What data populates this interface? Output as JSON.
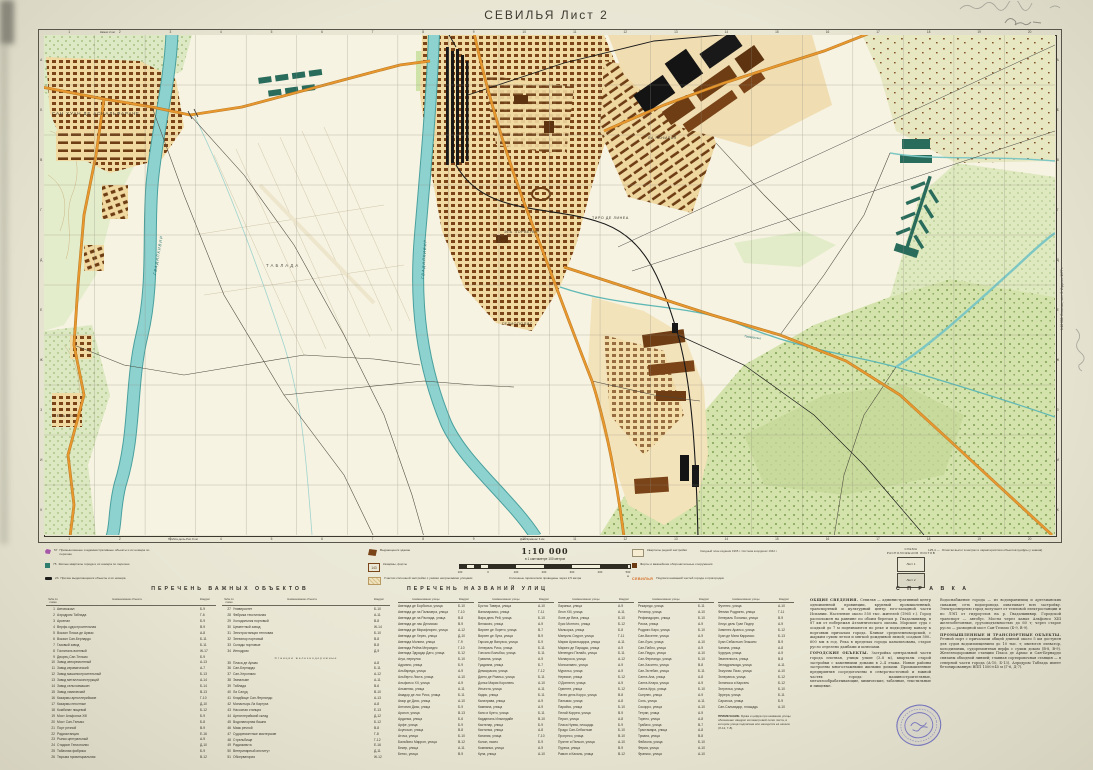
{
  "page": {
    "title": "СЕВИЛЬЯ  Лист 2",
    "edition_note": "1:10 000. Севилья, лист 2. Издание 1977 г.",
    "edge_notes": {
      "top": "Камас 2 км",
      "bottom1": "Пуэбла-дель-Рио 9 км",
      "bottom2": "Дос-Эрманас 6 км"
    }
  },
  "colors": {
    "paper": "#e9e6d4",
    "water": "#8ed2cf",
    "road": "#e8982e",
    "forest": "#d4e3ab",
    "building": "#7a4418",
    "stamp": "#5c5cb8"
  },
  "map": {
    "grid_cols": [
      "1",
      "2",
      "3",
      "4",
      "5",
      "6",
      "7",
      "8",
      "9",
      "10",
      "11",
      "12",
      "13",
      "14",
      "15",
      "16",
      "17",
      "18",
      "19",
      "20"
    ],
    "grid_rows": [
      "А",
      "Б",
      "В",
      "Г",
      "Д",
      "Е",
      "Ж",
      "З",
      "И",
      "К"
    ],
    "labels": {
      "town1": "САН ХУАН ДЕ АСНАЛЬФАРАЧЕ",
      "river1": "ГВАДАЛКИВИР",
      "river2": "ГВАДАЛКИВИР",
      "airfield": "ТАБЛАДА",
      "district1": "ТИРО ДЕ ЛИНЕА",
      "district2": "ЭЛЬ ПОРВЕНИР",
      "district3": "ГЕЛИОПОЛИС",
      "district4": "ЛА РАНИЛЬЯ",
      "village1": "ГЕЛЬВЕС",
      "stream1": "Тамаргильо"
    }
  },
  "scale": {
    "main": "1:10 000",
    "sub": "в 1 сантиметре 100 метров",
    "bar_labels": [
      "100",
      "0",
      "100",
      "200",
      "300",
      "400",
      "500 м"
    ],
    "contour_note": "Сплошные горизонтали проведены через 2,5 метра",
    "coord_note": "Сводный план издания 1965 г. Система координат 1942 г."
  },
  "scheme": {
    "title1": "СХЕМА",
    "title2": "РАСПОЛОЖЕНИЯ ЛИСТОВ",
    "sheets": [
      "Лист 1",
      "Лист 2"
    ]
  },
  "legend": {
    "items": [
      {
        "num": "57",
        "label": "Промышленные и административные объекты и их номера по перечню"
      },
      {
        "num": "75",
        "label": "Жилые кварталы города и их номера по перечню"
      },
      {
        "num": "23",
        "label": "Прочие выделяющиеся объекты и их номера"
      },
      {
        "num": "",
        "label": "Выдающееся здание"
      },
      {
        "num": "143",
        "label": "Казармы, форты"
      },
      {
        "num": "",
        "label": "Участки сплошной застройки с узкими непроезжими улицами"
      },
      {
        "num": "",
        "label": "Кварталы редкой застройки"
      },
      {
        "num": "",
        "label": "Форты и важнейшие оборонительные сооружения"
      },
      {
        "num": "СЕВИЛЬЯ",
        "label": "Подписи названий частей города и пригородов"
      },
      {
        "num": "125,4 —",
        "label": "Отметки высот в метрах и характеристики объектов (цифры у знаков)"
      }
    ]
  },
  "objects_table": {
    "title": "ПЕРЕЧЕНЬ  ВАЖНЫХ  ОБЪЕКТОВ",
    "headers": [
      "№№ по схеме",
      "Наименование объекта",
      "Квадрат"
    ],
    "groups": [
      [
        [
          "1",
          "Автовокзал",
          "Б-9"
        ],
        [
          "2",
          "Аэродром Таблада",
          "Г-6"
        ],
        [
          "3",
          "Арсенал",
          "Б-9"
        ],
        [
          "4",
          "Верфь судостроительная",
          "В-9"
        ],
        [
          "5",
          "Вокзал Пласа де Армас",
          "А-8"
        ],
        [
          "6",
          "Вокзал Сан-Бернардо",
          "Б-11"
        ],
        [
          "7",
          "Газовый завод",
          "Б-11"
        ],
        [
          "8",
          "Госпиталь военный",
          "Ж-17"
        ],
        [
          "9",
          "Дворец Сан-Тельмо",
          "Б-9"
        ],
        [
          "10",
          "Завод авторемонтный",
          "А-13"
        ],
        [
          "11",
          "Завод керамический",
          "А-7"
        ],
        [
          "12",
          "Завод машиностроительный",
          "Б-13"
        ],
        [
          "13",
          "Завод металлоконструкций",
          "А-14"
        ],
        [
          "14",
          "Завод сельхозмашин",
          "Б-14"
        ],
        [
          "15",
          "Завод химический",
          "В-13"
        ],
        [
          "16",
          "Казармы артиллерийские",
          "Г-10"
        ],
        [
          "17",
          "Казармы пехотные",
          "Д-10"
        ],
        [
          "18",
          "Комбинат пищевой",
          "Б-12"
        ],
        [
          "19",
          "Мост Альфонса XIII",
          "Б-9"
        ],
        [
          "20",
          "Мост Сан-Тельмо",
          "Б-8"
        ],
        [
          "21",
          "Порт речной",
          "В-9"
        ],
        [
          "22",
          "Радиостанция",
          "Е-16"
        ],
        [
          "23",
          "Рынок центральный",
          "А-9"
        ],
        [
          "24",
          "Стадион Гелиополис",
          "Д-10"
        ],
        [
          "25",
          "Табачная фабрика",
          "Б-9"
        ],
        [
          "26",
          "Тюрьма провинциальная",
          "В-12"
        ]
      ],
      [
        [
          "27",
          "Университет",
          "Б-10"
        ],
        [
          "28",
          "Фабрика текстильная",
          "А-11"
        ],
        [
          "29",
          "Холодильник портовый",
          "В-8"
        ],
        [
          "30",
          "Цементный завод",
          "Ж-14"
        ],
        [
          "31",
          "Электростанция тепловая",
          "Б-10"
        ],
        [
          "32",
          "Элеватор портовый",
          "В-8"
        ],
        [
          "33",
          "Склады портовые",
          "В-8"
        ],
        [
          "34",
          "Ипподром",
          "Д-9"
        ],
        {
          "sub": "Станции железнодорожные"
        },
        [
          "35",
          "Пласа де Армас",
          "А-8"
        ],
        [
          "36",
          "Сан-Бернардо",
          "Б-11"
        ],
        [
          "37",
          "Сан-Херонимо",
          "А-12"
        ],
        [
          "38",
          "Эмпальме",
          "А-11"
        ],
        [
          "39",
          "Таблада",
          "В-6"
        ],
        [
          "40",
          "Ла Салуд",
          "В-10"
        ],
        [
          "41",
          "Кладбище Сан-Фернандо",
          "А-13"
        ],
        [
          "42",
          "Монастырь Ла Картуха",
          "А-8"
        ],
        [
          "43",
          "Насосная станция",
          "Е-13"
        ],
        [
          "44",
          "Артиллерийский склад",
          "Д-12"
        ],
        [
          "45",
          "Водонапорная башня",
          "Б-12"
        ],
        [
          "46",
          "Маяк речной",
          "В-8"
        ],
        [
          "47",
          "Судоремонтные мастерские",
          "Г-8"
        ],
        [
          "48",
          "Стрельбище",
          "Г-12"
        ],
        [
          "49",
          "Радиомачта",
          "Е-16"
        ],
        [
          "50",
          "Ветеринарный институт",
          "Д-11"
        ],
        [
          "51",
          "Обсерватория",
          "Ж-12"
        ]
      ]
    ]
  },
  "streets_table": {
    "title": "ПЕРЕЧЕНЬ  НАЗВАНИЙ  УЛИЦ",
    "headers": [
      "Наименование улицы",
      "Квадрат"
    ],
    "groups": [
      [
        [
          "Авенида де Борболья, улица",
          "Б-10"
        ],
        [
          "Авенида де ла Пальмера, улица",
          "Г-10"
        ],
        [
          "Авенида де ла Распида, улица",
          "В-8"
        ],
        [
          "Авенида де лас Делисиас",
          "В-9"
        ],
        [
          "Авенида де Мирафлорес, улица",
          "А-12"
        ],
        [
          "Авенида де Херес, улица",
          "Д-10"
        ],
        [
          "Авенида Молини, улица",
          "Г-9"
        ],
        [
          "Авенида Рейна Мерседес",
          "Г-10"
        ],
        [
          "Авенида Эдуардо Дато, улица",
          "Б-12"
        ],
        [
          "Агуа, переулок",
          "Б-10"
        ],
        [
          "Адриано, улица",
          "Б-9"
        ],
        [
          "Альбареда, улица",
          "А-9"
        ],
        [
          "Альберто Листа, улица",
          "А-10"
        ],
        [
          "Альфонсо XII, улица",
          "А-9"
        ],
        [
          "Альменас, улица",
          "А-11"
        ],
        [
          "Амадор де лос Риос, улица",
          "Б-11"
        ],
        [
          "Амор де Диос, улица",
          "А-10"
        ],
        [
          "Антония Диас, улица",
          "Б-9"
        ],
        [
          "Арагон, улица",
          "В-13"
        ],
        [
          "Ардилья, улица",
          "Б-6"
        ],
        [
          "Арфе, улица",
          "Б-9"
        ],
        [
          "Асунсьон, улица",
          "В-8"
        ],
        [
          "Аточа, улица",
          "Б-10"
        ],
        [
          "Бальбино Маррон, улица",
          "В-12"
        ],
        [
          "Бекер, улица",
          "А-11"
        ],
        [
          "Бетис, улица",
          "В-9"
        ]
      ],
      [
        [
          "Бустос Тавера, улица",
          "А-10"
        ],
        [
          "Вальпараисо, улица",
          "Г-11"
        ],
        [
          "Вара дель Рей, улица",
          "Б-10"
        ],
        [
          "Веласкес, улица",
          "А-9"
        ],
        [
          "Вирхен де Лорето, улица",
          "В-7"
        ],
        [
          "Вирхен де Луха, улица",
          "В-9"
        ],
        [
          "Гарсия де Винуэса, улица",
          "Б-9"
        ],
        [
          "Хенераль Риос, улица",
          "Б-11"
        ],
        [
          "Гонсало Бильбао, улица",
          "Б-11"
        ],
        [
          "Гравина, улица",
          "А-9"
        ],
        [
          "Гуадиана, улица",
          "Б-7"
        ],
        [
          "Демокрасия, улица",
          "Г-12"
        ],
        [
          "Диего де Рианьо, улица",
          "Б-11"
        ],
        [
          "Донья Мария Коронель",
          "А-10"
        ],
        [
          "Иньеста, улица",
          "А-11"
        ],
        [
          "Кадис, улица",
          "Б-11"
        ],
        [
          "Калатрава, улица",
          "А-9"
        ],
        [
          "Кампана, улица",
          "А-9"
        ],
        [
          "Кано и Куэто, улица",
          "Б-11"
        ],
        [
          "Кардиналь Ильюндайн",
          "В-10"
        ],
        [
          "Кастелар, улица",
          "Б-9"
        ],
        [
          "Кастилья, улица",
          "А-8"
        ],
        [
          "Катания, улица",
          "Г-10"
        ],
        [
          "Колон, пасео",
          "Б-9"
        ],
        [
          "Компанья, улица",
          "А-9"
        ],
        [
          "Куна, улица",
          "А-10"
        ]
      ],
      [
        [
          "Лараньи, улица",
          "А-9"
        ],
        [
          "Леон XIII, улица",
          "А-11"
        ],
        [
          "Лопе де Вега, улица",
          "Б-10"
        ],
        [
          "Луис Монтото, улица",
          "Б-12"
        ],
        [
          "Мальорка, улица",
          "Б-8"
        ],
        [
          "Мануэль Сиурот, улица",
          "Г-11"
        ],
        [
          "Мария Аусильядора, улица",
          "А-11"
        ],
        [
          "Маркес де Парадас, улица",
          "А-9"
        ],
        [
          "Менендес Пелайо, улица",
          "Б-11"
        ],
        [
          "Милагроса, улица",
          "А-12"
        ],
        [
          "Монсальвес, улица",
          "А-9"
        ],
        [
          "Мурильо, улица",
          "А-9"
        ],
        [
          "Нервион, улица",
          "Б-12"
        ],
        [
          "О'Доннелл, улица",
          "А-9"
        ],
        [
          "Ориенте, улица",
          "Б-12"
        ],
        [
          "Пахес дель Корро, улица",
          "В-8"
        ],
        [
          "Пальмас, улица",
          "А-8"
        ],
        [
          "Парайсо, улица",
          "Б-10"
        ],
        [
          "Пелай Корреа, улица",
          "В-9"
        ],
        [
          "Перал, улица",
          "А-8"
        ],
        [
          "Пласа Нуэва, площадь",
          "Б-9"
        ],
        [
          "Прадо Сан-Себастьян",
          "Б-10"
        ],
        [
          "Прогресо, улица",
          "В-10"
        ],
        [
          "Пуэнте и Пельон, улица",
          "А-10"
        ],
        [
          "Пуреса, улица",
          "В-9"
        ],
        [
          "Рамон и Кахаль, улица",
          "В-12"
        ]
      ],
      [
        [
          "Рекаредо, улица",
          "Б-11"
        ],
        [
          "Релатор, улица",
          "А-10"
        ],
        [
          "Рефинадорес, улица",
          "Б-10"
        ],
        [
          "Риоха, улица",
          "А-9"
        ],
        [
          "Родриго Каро, улица",
          "Б-10"
        ],
        [
          "Сан-Висенте, улица",
          "А-9"
        ],
        [
          "Сан-Луис, улица",
          "А-10"
        ],
        [
          "Сан-Пабло, улица",
          "А-9"
        ],
        [
          "Сан-Педро, улица",
          "А-10"
        ],
        [
          "Сан-Фернандо, улица",
          "Б-10"
        ],
        [
          "Сан-Хасинто, улица",
          "В-8"
        ],
        [
          "Сан-Эстебан, улица",
          "Б-11"
        ],
        [
          "Санта-Ана, улица",
          "А-8"
        ],
        [
          "Санта-Клара, улица",
          "А-9"
        ],
        [
          "Санта-Крус, улица",
          "Б-10"
        ],
        [
          "Сьерпес, улица",
          "А-9"
        ],
        [
          "Соль, улица",
          "А-11"
        ],
        [
          "Сокорро, улица",
          "А-10"
        ],
        [
          "Тетуан, улица",
          "А-9"
        ],
        [
          "Торнео, улица",
          "А-8"
        ],
        [
          "Трабахо, улица",
          "В-7"
        ],
        [
          "Трастамара, улица",
          "А-8"
        ],
        [
          "Триана, улица",
          "В-8"
        ],
        [
          "Фабиола, улица",
          "Б-10"
        ],
        [
          "Фериа, улица",
          "А-10"
        ],
        [
          "Франкос, улица",
          "А-10"
        ]
      ],
      [
        [
          "Фуэнтес, улица",
          "А-10"
        ],
        [
          "Феликс Родригес, улица",
          "Г-11"
        ],
        [
          "Хенераль Поланко, улица",
          "В-9"
        ],
        [
          "Хесус дель Гран Подер",
          "А-9"
        ],
        [
          "Хименес Арансо, улица",
          "Б-12"
        ],
        [
          "Хуан де Мата Карриасо",
          "Б-13"
        ],
        [
          "Хуан Себастьян Элькано",
          "В-9"
        ],
        [
          "Чапина, улица",
          "А-8"
        ],
        [
          "Чуррука, улица",
          "А-9"
        ],
        [
          "Эвангелиста, улица",
          "В-8"
        ],
        [
          "Энладрильяда, улица",
          "А-11"
        ],
        [
          "Эскуэлас Пиас, улица",
          "А-10"
        ],
        [
          "Эсперанса, улица",
          "Б-12"
        ],
        [
          "Эспиноса и Карсель",
          "Б-12"
        ],
        [
          "Эстрелья, улица",
          "Б-10"
        ],
        [
          "Эррера, улица",
          "Б-11"
        ],
        [
          "Сарагоса, улица",
          "Б-9"
        ],
        [
          "Сан-Сальвадор, площадь",
          "А-10"
        ]
      ]
    ],
    "note_title": "ПРИМЕЧАНИЕ.",
    "note": "Буква и цифра при названии улицы обозначают квадрат километровой сетки листа, в котором улица подписана или находится её начало (Л-12, Г-8)."
  },
  "spravka": {
    "title": "С П Р А В К А",
    "columns": [
      [
        {
          "lead": "ОБЩИЕ СВЕДЕНИЯ.",
          "text": "Севилья — административный центр одноименной провинции, крупный промышленный, транспортный и культурный центр юго-западной части Испании. Население около 550 тыс. жителей (1965 г.). Город расположен на равнине по обоим берегам р. Гвадалквивир, в 87 км от побережья Атлантического океана. Морские суда с осадкой до 7 м поднимаются по реке и подходному каналу к портовым причалам города. Климат средиземноморский, с жарким сухим летом и мягкой дождливой зимой; осадков 500–600 мм в год. Река в пределах города канализована, старое русло отделено дамбами и шлюзами."
        },
        {
          "lead": "ГОРОДСКИЕ ОБЪЕКТЫ.",
          "text": "Застройка центральной части города плотная, улицы узкие (3–8 м), кварталы старой застройки с каменными домами в 2–4 этажа. Новые районы застроены многоэтажными жилыми домами. Промышленные предприятия сосредоточены в северо-восточной и южной частях города: машиностроительные, металлообрабатывающие, химические, табачные, текстильные и пищевые."
        }
      ],
      [
        {
          "lead": "",
          "text": "Водоснабжение города — из водохранилищ и артезианских скважин; сеть водопровода охватывает всю застройку. Электроэнергию город получает от тепловой электростанции и по ЛЭП от гидроузлов на р. Гвадалквивир. Городской транспорт — автобус. Мосты через канал Альфонсо XIII железобетонные, грузоподъемностью до 60 т; через старое русло — разводной мост Сан-Тельмо (Б-9, В-9)."
        },
        {
          "lead": "ПРОМЫШЛЕННЫЕ И ТРАНСПОРТНЫЕ ОБЪЕКТЫ.",
          "text": "Речной порт с причалами общей длиной около 5 км доступен для судов водоизмещением до 10 тыс. т; имеются элеватор, холодильник, судоремонтная верфь с сухим доком (В-8, В-9). Железнодорожные станции Пласа де Армас и Сан-Бернардо связаны обходной линией; главная сортировочная станция — в северной части города (А-10, Б-13). Аэродром Таблада имеет бетонированную ВПП 1500×45 м (Г-6, Д-7)."
        }
      ]
    ]
  }
}
